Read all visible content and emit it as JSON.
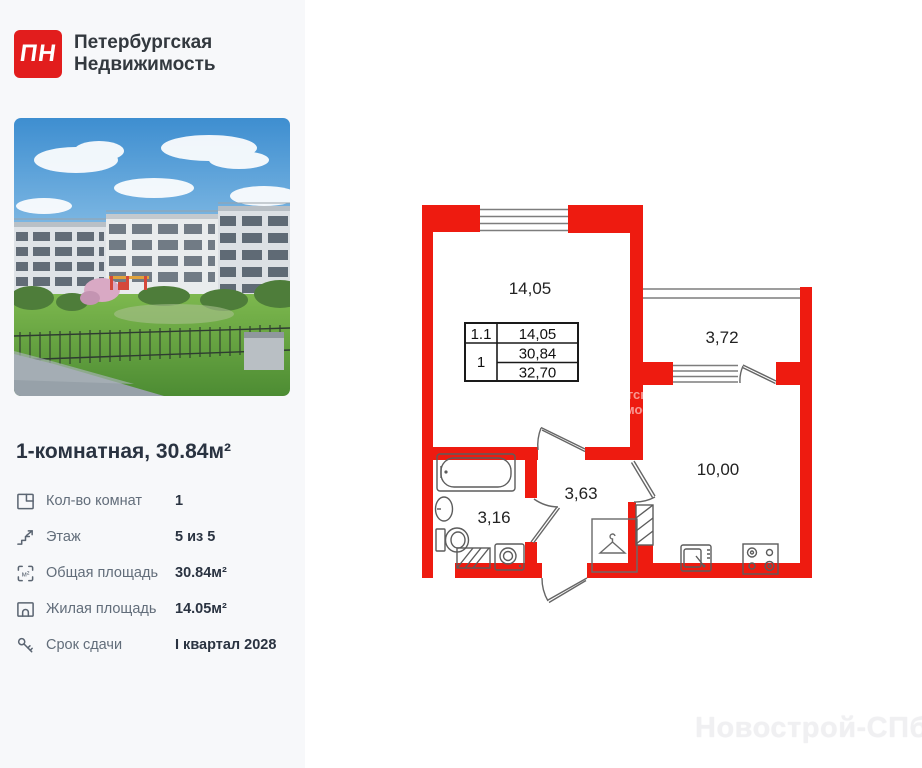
{
  "brand": {
    "logo_text": "ПН",
    "name_line1": "Петербургская",
    "name_line2": "Недвижимость"
  },
  "listing": {
    "title": "1-комнатная, 30.84м²"
  },
  "specs": [
    {
      "icon": "rooms-icon",
      "label": "Кол-во комнат",
      "value": "1"
    },
    {
      "icon": "floor-icon",
      "label": "Этаж",
      "value": "5 из 5"
    },
    {
      "icon": "total-area-icon",
      "label": "Общая площадь",
      "value": "30.84м²"
    },
    {
      "icon": "living-area-icon",
      "label": "Жилая площадь",
      "value": "14.05м²"
    },
    {
      "icon": "key-icon",
      "label": "Срок сдачи",
      "value": "I квартал 2028"
    }
  ],
  "floorplan": {
    "colors": {
      "wall": "#ee1b10",
      "lines": "#7d7d7d",
      "fixtures": "#5c5c5c"
    },
    "rooms": {
      "living": {
        "area": "14,05"
      },
      "balcony": {
        "area": "3,72"
      },
      "kitchen": {
        "area": "10,00"
      },
      "hallway": {
        "area": "3,63"
      },
      "bathroom": {
        "area": "3,16"
      }
    },
    "table": {
      "unit_number": "1.1",
      "living_area": "14,05",
      "rooms_count": "1",
      "area_main": "30,84",
      "area_total": "32,70"
    }
  },
  "watermark": {
    "text": "Новострой-СПб"
  }
}
